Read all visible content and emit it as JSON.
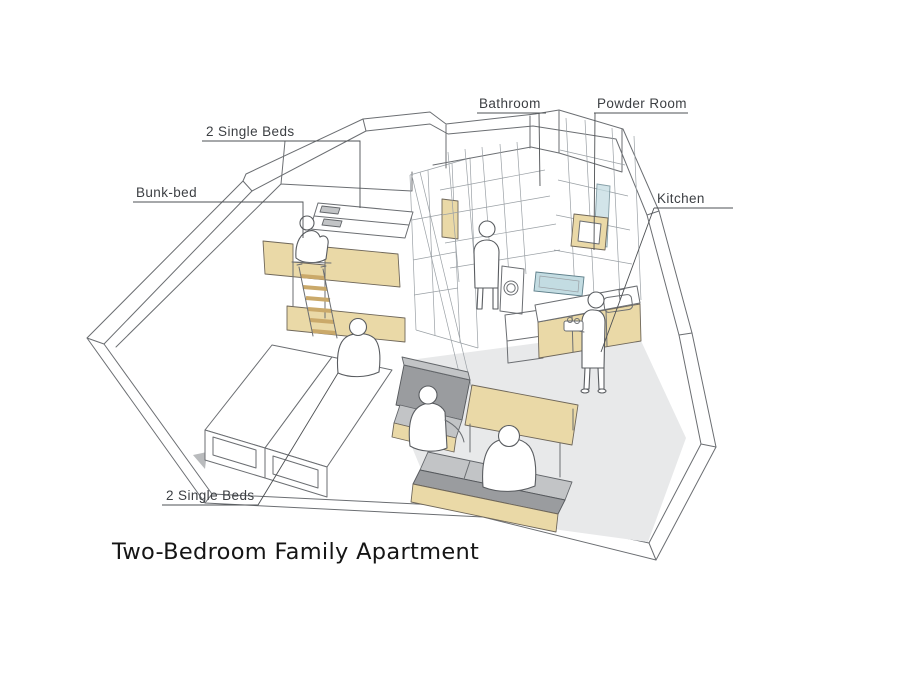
{
  "title": "Two-Bedroom Family Apartment",
  "labels": {
    "single_beds_top": "2 Single Beds",
    "bunk_bed": "Bunk-bed",
    "bathroom": "Bathroom",
    "powder_room": "Powder Room",
    "kitchen": "Kitchen",
    "single_beds_bottom": "2 Single Beds"
  },
  "scene": {
    "type": "axonometric cutaway sketch of an apartment",
    "rooms": [
      "Bedroom with bunk-bed and 2 single beds",
      "Bathroom",
      "Powder Room",
      "Kitchen",
      "Living-dining area"
    ],
    "figure_count": 6
  },
  "colors": {
    "wood": "#ead9a7",
    "wood_dark": "#e2c88e",
    "sofa_gray": "#c2c4c6",
    "sofa_gray_dark": "#9a9c9f",
    "floor_gray": "#e8e9ea",
    "water_blue": "#c3dce2",
    "line": "#6b6e72",
    "label_text": "#3c3f43",
    "title_text": "#151515"
  }
}
